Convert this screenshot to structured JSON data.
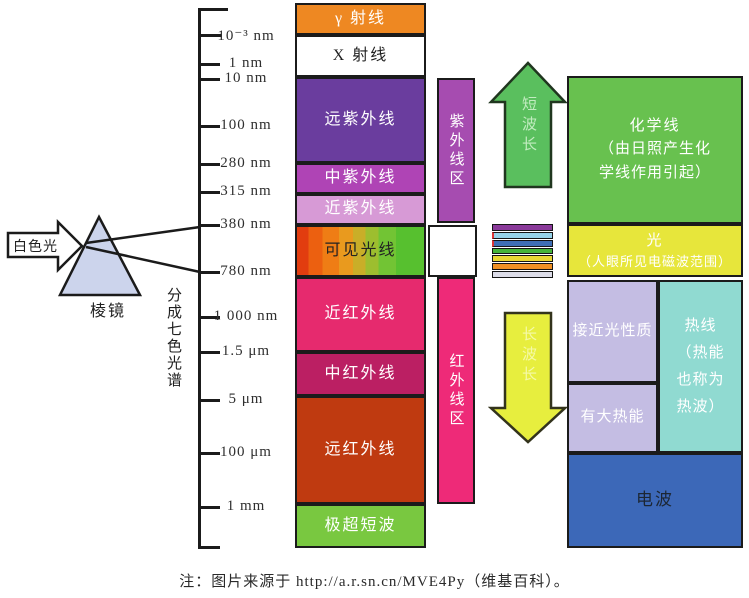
{
  "left_group": {
    "white_light_label": "白色光",
    "prism_label": "棱镜",
    "split_label": "分成七色光谱"
  },
  "scale": {
    "ticks": [
      "10⁻³ nm",
      "1 nm",
      "10 nm",
      "100 nm",
      "280 nm",
      "315 nm",
      "380 nm",
      "780 nm",
      "1 000 nm",
      "1.5 μm",
      "5 μm",
      "100 μm",
      "1 mm"
    ]
  },
  "spectrum_blocks": {
    "gamma": {
      "label": "γ 射线",
      "color": "#ee8822"
    },
    "xray": {
      "label": "X 射线",
      "color": "#ffffff"
    },
    "far_uv": {
      "label": "远紫外线",
      "color": "#6a3d9e"
    },
    "mid_uv": {
      "label": "中紫外线",
      "color": "#af44b5"
    },
    "near_uv": {
      "label": "近紫外线",
      "color": "#d79ad6"
    },
    "visible": {
      "label": "可见光线",
      "color": "red-to-green rainbow gradient"
    },
    "near_ir": {
      "label": "近红外线",
      "color": "#e62a6e"
    },
    "mid_ir": {
      "label": "中红外线",
      "color": "#bb1f63"
    },
    "far_ir": {
      "label": "远红外线",
      "color": "#bf3a10"
    },
    "uhf": {
      "label": "极超短波",
      "color": "#79c840"
    }
  },
  "region_bars": {
    "uv": {
      "label": "紫外线区",
      "color": "#a64cb0"
    },
    "ir": {
      "label": "红外线区",
      "color": "#ee2a78"
    }
  },
  "arrows": {
    "short_wave": {
      "label": "短波长",
      "color": "#5abf5e"
    },
    "long_wave": {
      "label": "长波长",
      "color": "#e7ee3e"
    }
  },
  "visible_strip": {
    "colors": [
      "#8a3a9a",
      "#96d2e8",
      "#3f6eb4",
      "#45b33a",
      "#e8d834",
      "#ef9025",
      "#dcdce8"
    ]
  },
  "right_blocks": {
    "chemical": {
      "line1": "化学线",
      "line2": "（由日照产生化",
      "line3": "学线作用引起）",
      "color": "#68c14f"
    },
    "light": {
      "line1": "光",
      "line2": "（人眼所见电磁波范围）",
      "color": "#e7e63b"
    },
    "near_light": {
      "label": "接近光性质",
      "color": "#c4bde3"
    },
    "big_heat": {
      "label": "有大热能",
      "color": "#c4bde3"
    },
    "heat_ray": {
      "line1": "热线",
      "line2": "（热能",
      "line3": "也称为",
      "line4": "热波）",
      "color": "#90dad1"
    },
    "radio": {
      "label": "电波",
      "color": "#3c68b8"
    }
  },
  "footer": {
    "note": "注：图片来源于 http://a.r.sn.cn/MVE4Py（维基百科）。"
  }
}
